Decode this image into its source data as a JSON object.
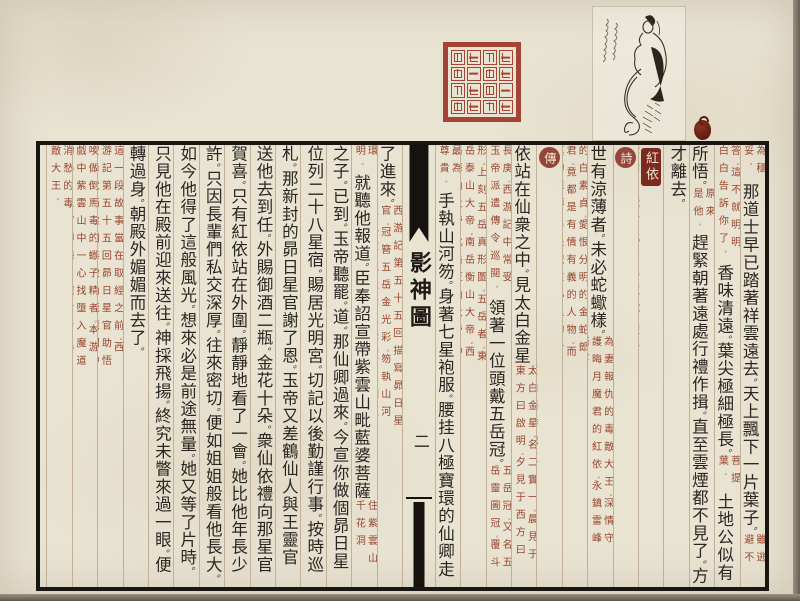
{
  "page": {
    "book_title": "影神圖",
    "page_number": "二",
    "entry_title": "紅依",
    "section_marker_poem": "詩",
    "section_marker_biography": "傳"
  },
  "colors": {
    "paper": "#e9e3d2",
    "ink": "#2b2622",
    "annotation_red": "#99452f",
    "entry_badge_red": "#7c2a1f",
    "seal_red": "#a03629",
    "frame_black": "#191510"
  },
  "ornaments": {
    "seal_icon": "seal-stamp",
    "illustration_icon": "snake-woman-ink-illustration",
    "inscription_icon": "cursive-inscription",
    "bead_icon": "red-bead-ornament"
  },
  "columns_right": [
    {
      "parts": [
        {
          "type": "note",
          "text": "為穩妥。"
        },
        {
          "type": "large",
          "text": "那道士早已踏著祥雲遠去。天上飄下一片葉子。"
        },
        {
          "type": "note",
          "text": "雖逃避不"
        }
      ]
    },
    {
      "parts": [
        {
          "type": "note",
          "text": "答。這不就明明白白告訴你了。"
        },
        {
          "type": "large",
          "text": "香味清遠。葉尖極細極長。"
        },
        {
          "type": "note",
          "text": "菩提葉。"
        },
        {
          "type": "large",
          "text": "土地公似有"
        }
      ]
    },
    {
      "parts": [
        {
          "type": "large",
          "text": "所悟。"
        },
        {
          "type": "note",
          "text": "原來是他。"
        },
        {
          "type": "large",
          "text": "趕緊朝著遠處行禮作揖。直至雲煙都不見了。方"
        }
      ]
    },
    {
      "parts": [
        {
          "type": "large",
          "text": "才離去。"
        }
      ]
    },
    {
      "parts": [
        {
          "type": "entry",
          "text": "紅依"
        },
        {
          "type": "note",
          "text": "紫雲山麓下化身為紅蛇。假扮祭悼亡夫未亡人。引導天命人前去解脫墮入魔道的晦月魔君。"
        }
      ]
    },
    {
      "parts": [
        {
          "type": "marker",
          "text": "詩"
        },
        {
          "type": "large",
          "text": "淚眼思淚眼。斷腸複斷腸。"
        },
        {
          "type": "note",
          "text": "京劇薛仁貴征東。川劇祝莊訪友。"
        },
        {
          "type": "note",
          "text": "流淚眼觀流淚眼。斷腸人送斷腸人。傳統戲曲水詞代表。引用見"
        }
      ]
    },
    {
      "parts": [
        {
          "type": "large",
          "text": "世有涼薄者。未必蛇蠍樣。"
        },
        {
          "type": "note",
          "text": "為妻報仇的毒敵大王。深情守護晦月魔君的紅依。永鎮雷峰塔下"
        }
      ]
    },
    {
      "parts": [
        {
          "type": "note",
          "text": "的白素貞。愛恨分明的金蛇郎君。竟都是有情有義的人物。而真的涼薄。乃是藏在心里的冷漠。"
        }
      ]
    },
    {
      "parts": [
        {
          "type": "marker",
          "text": "傳"
        },
        {
          "type": "large",
          "text": "玉帝駕座金闕雲宮靈霄寶殿。"
        },
        {
          "type": "note",
          "text": "直用西游記玉帝登場原文。"
        },
        {
          "type": "large",
          "text": "聚集仙卿。紅"
        }
      ]
    },
    {
      "parts": [
        {
          "type": "large",
          "text": "依站在仙衆之中。見太白金星"
        },
        {
          "type": "note",
          "text": "太白金星。名二實一。晨見于東方曰啟明。夕見于西方曰"
        }
      ]
    },
    {
      "parts": [
        {
          "type": "note",
          "text": "長庚。西游記中常受玉帝派遣傳令巡閱。"
        },
        {
          "type": "large",
          "text": "領著一位頭戴五岳冠。"
        },
        {
          "type": "note",
          "text": "五岳冠。又名五岳靈圖冠。覆斗"
        }
      ]
    },
    {
      "parts": [
        {
          "type": "note",
          "text": "形。上刻五岳真形圖。五岳者。東岳泰山大帝。南岳衡山大帝。西岳華山大帝。北岳恆山大帝。中岳嵩山大帝。以東岳大帝"
        }
      ]
    },
    {
      "parts": [
        {
          "type": "note",
          "text": "最為尊貴。"
        },
        {
          "type": "large",
          "text": "手執山河笏。身著七星袍服。腰挂八極寶環的仙卿走"
        }
      ]
    }
  ],
  "columns_left": [
    {
      "parts": [
        {
          "type": "large",
          "text": "了進來。"
        },
        {
          "type": "note",
          "text": "西游記第五十五回描寫昴日星官。冠簪五岳金光彩。笏執山河玉色瓊。袍挂七星雲霞。腰圍八極寶"
        }
      ]
    },
    {
      "parts": [
        {
          "type": "note",
          "text": "環明。"
        },
        {
          "type": "large",
          "text": "就聽他報道。臣奉詔宣帶紫雲山毗藍婆菩薩"
        },
        {
          "type": "note",
          "text": "住紫雲山千花洞"
        }
      ]
    },
    {
      "parts": [
        {
          "type": "large",
          "text": "之子。已到。玉帝聽罷。道。那仙卿過來。今宣你做個昴日星官。"
        }
      ]
    },
    {
      "parts": [
        {
          "type": "large",
          "text": "位列二十八星宿。賜居光明宮。切記以後勤謹行事。按時巡"
        }
      ]
    },
    {
      "parts": [
        {
          "type": "large",
          "text": "札。那新封的昴日星官謝了恩。玉帝又差鶴仙人與王靈官"
        }
      ]
    },
    {
      "parts": [
        {
          "type": "large",
          "text": "送他去到任。外賜御酒二瓶。金花十朵。衆仙依禮向那星官"
        }
      ]
    },
    {
      "parts": [
        {
          "type": "large",
          "text": "賀喜。只有紅依站在外圍。靜靜地看了一會。她比他年長少"
        }
      ]
    },
    {
      "parts": [
        {
          "type": "large",
          "text": "許。只因長輩們私交深厚。往來密切。便如姐姐般看他長大。"
        }
      ]
    },
    {
      "parts": [
        {
          "type": "large",
          "text": "如今他得了這般風光。想來必是前途無量。她又等了片時。"
        }
      ]
    },
    {
      "parts": [
        {
          "type": "large",
          "text": "只見他在殿前迎來送往。神採飛揚。終究未瞥來過一眼。便"
        }
      ]
    },
    {
      "parts": [
        {
          "type": "large",
          "text": "轉過身。朝殿外媚媚而去了。"
        }
      ]
    },
    {
      "parts": [
        {
          "type": "note",
          "text": "這一段故事當在取經之前。西游記第五十五回昴日星官助悟空降伏西梁國毒敵山琵琶洞中尾上一個鉤子"
        }
      ]
    },
    {
      "parts": [
        {
          "type": "note",
          "text": "喚做倒馬毒的蠍子精者。本游戲中紫雲山中一心找墮入魔道的昴日星官即晦月魔君者。尋仇不得終日飲酒"
        }
      ]
    },
    {
      "parts": [
        {
          "type": "note",
          "text": "消愁的毒敵大王。"
        }
      ]
    }
  ]
}
